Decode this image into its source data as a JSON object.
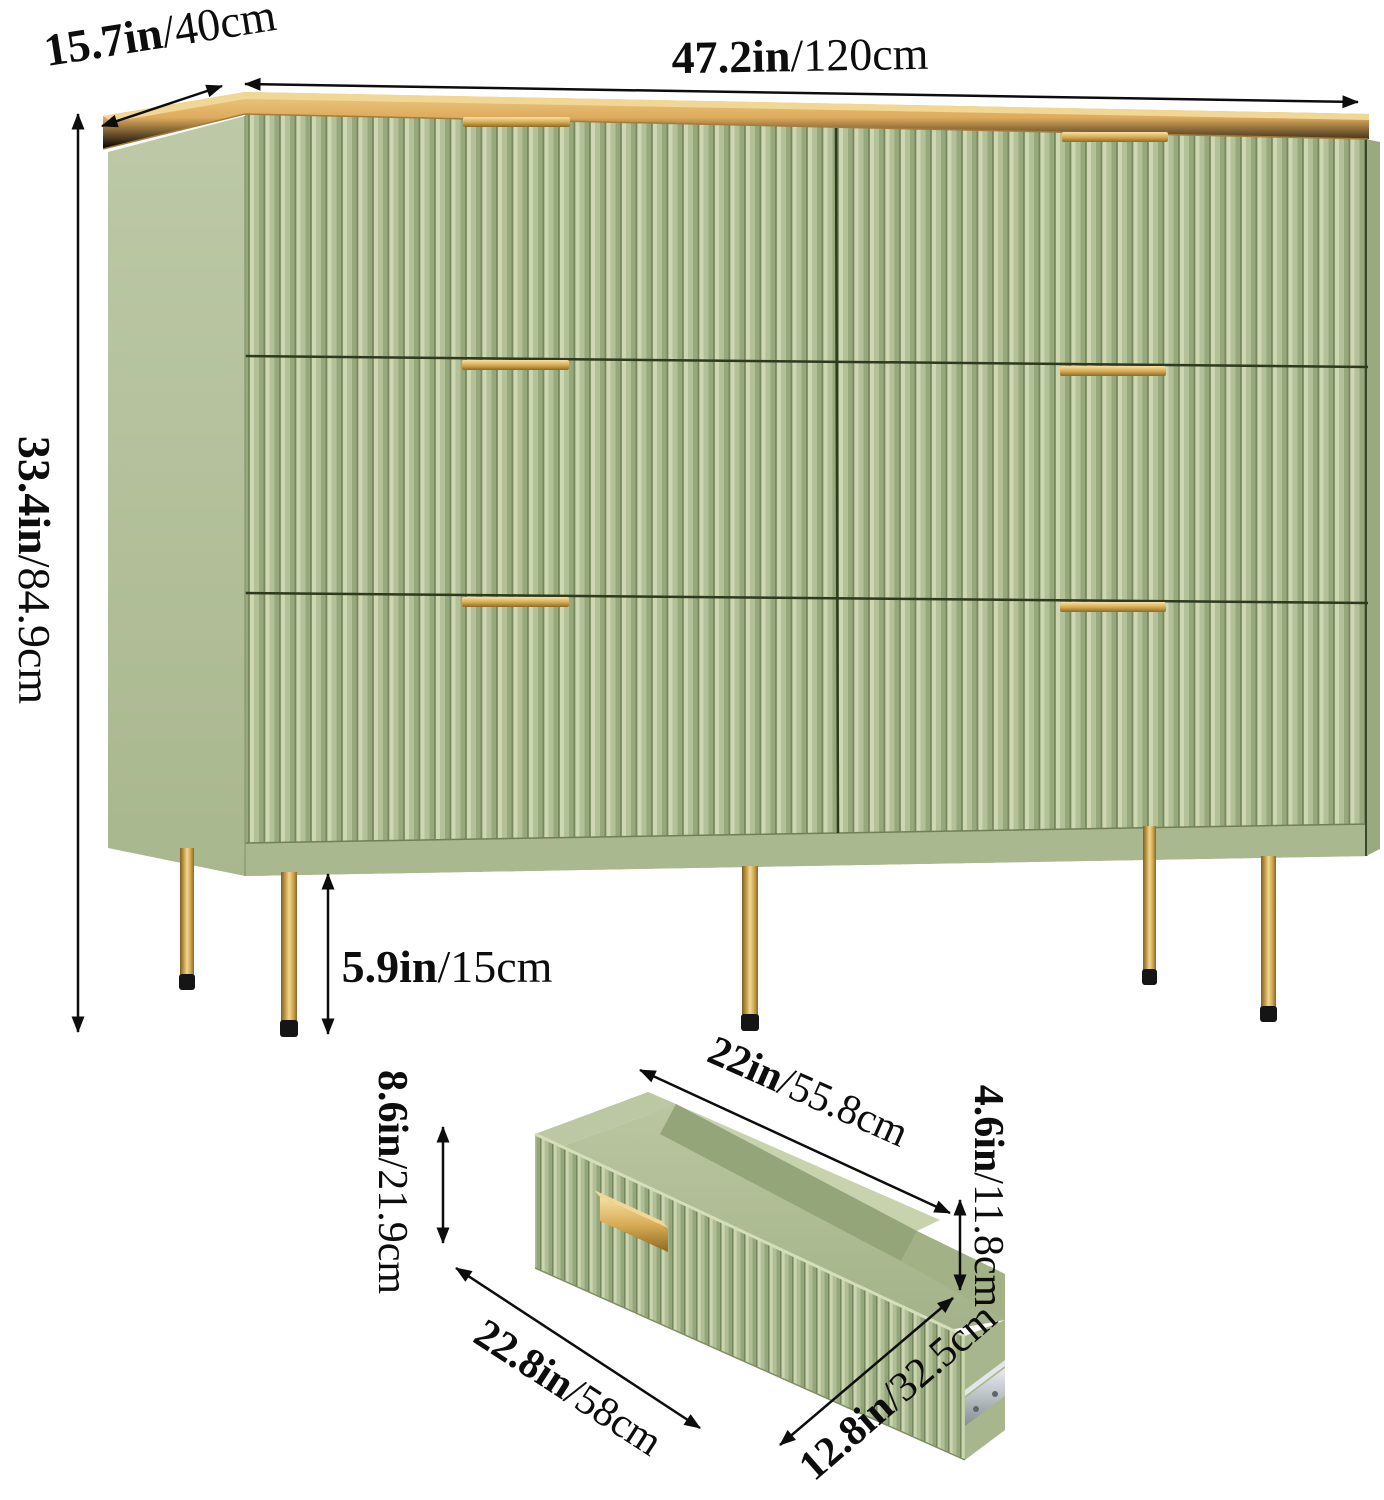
{
  "image_type": "product dimension diagram",
  "subject": "six-drawer fluted dresser with wood top, gold handles and gold legs, plus single drawer detail",
  "colors": {
    "background": "#ffffff",
    "sage_body": "#b9c5a2",
    "sage_flute_light": "#cdd7b2",
    "sage_flute_dark": "#97a87c",
    "wood_top": "#dfb269",
    "gold_hardware": "#d8ad56",
    "leg_cap": "#151515",
    "metal_slide": "#ccd2d5",
    "dimension_ink": "#0d0d0d"
  },
  "dimensions": {
    "dresser": {
      "depth": {
        "in": "15.7in",
        "cm": "/40cm"
      },
      "width": {
        "in": "47.2in",
        "cm": "/120cm"
      },
      "height": {
        "in": "33.4in",
        "cm": "/84.9cm"
      },
      "leg_height": {
        "in": "5.9in",
        "cm": "/15cm"
      }
    },
    "drawer": {
      "top_width": {
        "in": "22in",
        "cm": "/55.8cm"
      },
      "front_height": {
        "in": "8.6in",
        "cm": "/21.9cm"
      },
      "inner_height": {
        "in": "4.6in",
        "cm": "/11.8cm"
      },
      "front_width": {
        "in": "22.8in",
        "cm": "/58cm"
      },
      "depth": {
        "in": "12.8in",
        "cm": "/32.5cm"
      }
    }
  }
}
